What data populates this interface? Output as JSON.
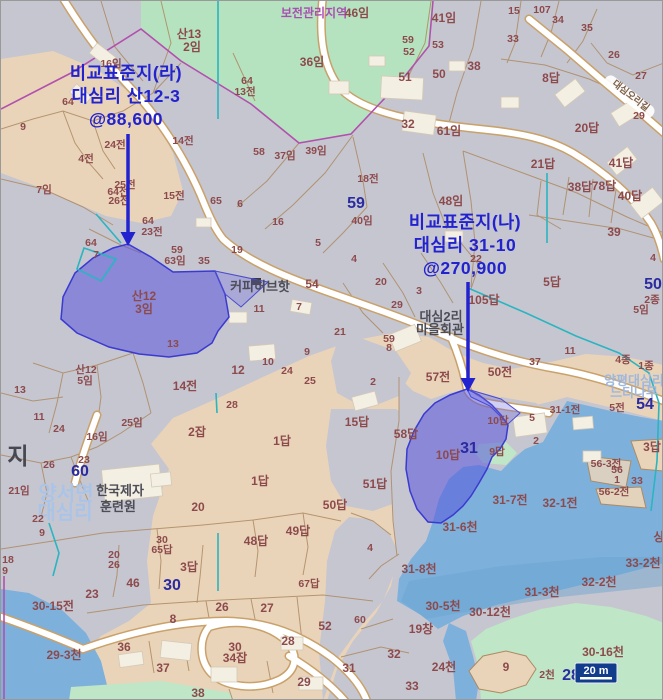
{
  "map": {
    "colors": {
      "base_gray": "#c6c6d0",
      "farmland_tan": "#e9d4ba",
      "forest_green": "#b5e3c0",
      "stream_blue": "#7db1dc",
      "highlight_parcel": "#5a55dc",
      "annotation_blue": "#2222cf",
      "lot_number_blue": "#2b2ba0",
      "parcel_text": "#8d4a4c",
      "zone_purple": "#a84fb0",
      "scalebar_navy": "#123c8c"
    },
    "annotations": [
      {
        "name": "비교표준지(라)",
        "lines": [
          "비교표준지(라)",
          "대심리 산12-3",
          "@88,600"
        ],
        "x": 125,
        "y": 78,
        "line_gap": 23,
        "arrow": {
          "x": 127,
          "y1": 133,
          "y2": 231
        }
      },
      {
        "name": "비교표준지(나)",
        "lines": [
          "비교표준지(나)",
          "대심리 31-10",
          "@270,900"
        ],
        "x": 464,
        "y": 227,
        "line_gap": 23,
        "arrow": {
          "x": 467,
          "y1": 281,
          "y2": 377
        }
      }
    ],
    "scale_bar": {
      "label": "20 m"
    },
    "labels": [
      [
        "산13",
        188,
        37,
        "p2"
      ],
      [
        "2임",
        191,
        50,
        "p2"
      ],
      [
        "보전관리지역",
        313,
        16,
        "pl"
      ],
      [
        "46임",
        356,
        16,
        "p2"
      ],
      [
        "36임",
        311,
        65,
        "p2"
      ],
      [
        "16임",
        110,
        66,
        "p"
      ],
      [
        "64",
        246,
        83,
        "p"
      ],
      [
        "13전",
        244,
        94,
        "p"
      ],
      [
        "41임",
        443,
        21,
        "p2"
      ],
      [
        "15",
        513,
        13,
        "p"
      ],
      [
        "107",
        541,
        12,
        "p"
      ],
      [
        "34",
        557,
        22,
        "p"
      ],
      [
        "35",
        586,
        30,
        "p"
      ],
      [
        "33",
        512,
        41,
        "p"
      ],
      [
        "26",
        613,
        57,
        "p"
      ],
      [
        "27",
        640,
        78,
        "p"
      ],
      [
        "29",
        638,
        118,
        "p"
      ],
      [
        "59",
        407,
        42,
        "p"
      ],
      [
        "52",
        408,
        54,
        "p"
      ],
      [
        "53",
        437,
        47,
        "p"
      ],
      [
        "50",
        438,
        77,
        "p2"
      ],
      [
        "51",
        404,
        80,
        "p2"
      ],
      [
        "38",
        473,
        69,
        "p2"
      ],
      [
        "8답",
        550,
        81,
        "p2"
      ],
      [
        "32",
        407,
        127,
        "p2"
      ],
      [
        "61임",
        448,
        134,
        "p2"
      ],
      [
        "20답",
        586,
        131,
        "p2"
      ],
      [
        "21답",
        542,
        167,
        "p2"
      ],
      [
        "41답",
        620,
        166,
        "p2"
      ],
      [
        "38답",
        579,
        190,
        "p2"
      ],
      [
        "78답",
        603,
        189,
        "p2"
      ],
      [
        "40답",
        629,
        199,
        "p2"
      ],
      [
        "39",
        613,
        235,
        "p2"
      ],
      [
        "4",
        652,
        260,
        "p"
      ],
      [
        "9",
        22,
        129,
        "p"
      ],
      [
        "24전",
        114,
        147,
        "p"
      ],
      [
        "4전",
        85,
        161,
        "p"
      ],
      [
        "14전",
        182,
        143,
        "p"
      ],
      [
        "58",
        258,
        154,
        "p"
      ],
      [
        "37임",
        284,
        158,
        "p"
      ],
      [
        "39임",
        315,
        153,
        "p"
      ],
      [
        "64",
        67,
        104,
        "p"
      ],
      [
        "7임",
        43,
        192,
        "p"
      ],
      [
        "25전",
        124,
        187,
        "p"
      ],
      [
        "64전",
        117,
        194,
        "p"
      ],
      [
        "26전",
        118,
        203,
        "p"
      ],
      [
        "15전",
        173,
        198,
        "p"
      ],
      [
        "64",
        147,
        223,
        "p"
      ],
      [
        "23전",
        151,
        234,
        "p"
      ],
      [
        "65",
        215,
        203,
        "p"
      ],
      [
        "6",
        239,
        206,
        "p"
      ],
      [
        "16",
        277,
        224,
        "p"
      ],
      [
        "5",
        317,
        245,
        "p"
      ],
      [
        "19",
        236,
        252,
        "p"
      ],
      [
        "59",
        176,
        252,
        "p"
      ],
      [
        "63임",
        174,
        263,
        "p"
      ],
      [
        "35",
        203,
        263,
        "p"
      ],
      [
        "64",
        90,
        245,
        "p"
      ],
      [
        "7",
        95,
        257,
        "p"
      ],
      [
        "산12",
        143,
        299,
        "p2"
      ],
      [
        "3임",
        143,
        312,
        "p2"
      ],
      [
        "커피허브핫",
        259,
        290,
        "place"
      ],
      [
        "54",
        311,
        287,
        "p2"
      ],
      [
        "11",
        258,
        311,
        "p"
      ],
      [
        "7",
        298,
        309,
        "p"
      ],
      [
        "21",
        339,
        334,
        "p"
      ],
      [
        "13",
        172,
        346,
        "p"
      ],
      [
        "18전",
        367,
        181,
        "p"
      ],
      [
        "59",
        355,
        207,
        "b"
      ],
      [
        "40임",
        361,
        223,
        "p"
      ],
      [
        "48임",
        450,
        204,
        "p2"
      ],
      [
        "22",
        475,
        261,
        "p"
      ],
      [
        "4",
        353,
        261,
        "p"
      ],
      [
        "20",
        380,
        284,
        "p"
      ],
      [
        "3",
        418,
        293,
        "p"
      ],
      [
        "29",
        396,
        307,
        "p"
      ],
      [
        "105답",
        483,
        303,
        "p2"
      ],
      [
        "5답",
        551,
        285,
        "p2"
      ],
      [
        "50",
        652,
        288,
        "b"
      ],
      [
        "2종",
        651,
        302,
        "p"
      ],
      [
        "5임",
        640,
        312,
        "p"
      ],
      [
        "대심2리",
        440,
        320,
        "place"
      ],
      [
        "마을회관",
        439,
        333,
        "place"
      ],
      [
        "59",
        388,
        341,
        "p"
      ],
      [
        "8",
        388,
        350,
        "p"
      ],
      [
        "산12",
        85,
        372,
        "p"
      ],
      [
        "5임",
        84,
        383,
        "p"
      ],
      [
        "13",
        19,
        392,
        "p"
      ],
      [
        "11",
        38,
        419,
        "p"
      ],
      [
        "24",
        58,
        431,
        "p"
      ],
      [
        "25임",
        131,
        425,
        "p"
      ],
      [
        "16임",
        96,
        439,
        "p"
      ],
      [
        "지",
        17,
        463,
        "bd"
      ],
      [
        "23",
        83,
        462,
        "p"
      ],
      [
        "26",
        48,
        467,
        "p"
      ],
      [
        "60",
        79,
        475,
        "b"
      ],
      [
        "21임",
        18,
        493,
        "p"
      ],
      [
        "양서면",
        65,
        499,
        "lb"
      ],
      [
        "대심리",
        64,
        518,
        "lb"
      ],
      [
        "22",
        37,
        521,
        "p"
      ],
      [
        "9",
        41,
        535,
        "p"
      ],
      [
        "한국제자",
        119,
        494,
        "place"
      ],
      [
        "훈련원",
        117,
        510,
        "place"
      ],
      [
        "14전",
        184,
        389,
        "p2"
      ],
      [
        "2잡",
        196,
        435,
        "p2"
      ],
      [
        "12",
        237,
        373,
        "p2"
      ],
      [
        "10",
        267,
        364,
        "p"
      ],
      [
        "9",
        306,
        354,
        "p"
      ],
      [
        "24",
        286,
        373,
        "p"
      ],
      [
        "25",
        309,
        383,
        "p"
      ],
      [
        "28",
        231,
        407,
        "p"
      ],
      [
        "1답",
        281,
        444,
        "p2"
      ],
      [
        "1답",
        259,
        484,
        "p2"
      ],
      [
        "20",
        197,
        510,
        "p2"
      ],
      [
        "50답",
        334,
        508,
        "p2"
      ],
      [
        "2",
        372,
        384,
        "p"
      ],
      [
        "57전",
        437,
        380,
        "p2"
      ],
      [
        "50전",
        499,
        375,
        "p2"
      ],
      [
        "37",
        534,
        364,
        "p"
      ],
      [
        "11",
        569,
        353,
        "p"
      ],
      [
        "4종",
        622,
        362,
        "p"
      ],
      [
        "1종",
        645,
        368,
        "p"
      ],
      [
        "양평대심리",
        633,
        384,
        "lb2"
      ],
      [
        "느티나무",
        633,
        396,
        "lb2"
      ],
      [
        "5전",
        616,
        410,
        "p"
      ],
      [
        "54",
        644,
        408,
        "b"
      ],
      [
        "31-1전",
        564,
        412,
        "p"
      ],
      [
        "5",
        531,
        420,
        "p"
      ],
      [
        "2",
        535,
        443,
        "p"
      ],
      [
        "10답",
        497,
        423,
        "p"
      ],
      [
        "15답",
        356,
        425,
        "p2"
      ],
      [
        "58답",
        405,
        437,
        "p2"
      ],
      [
        "10답",
        447,
        458,
        "p2"
      ],
      [
        "31",
        468,
        452,
        "b"
      ],
      [
        "9답",
        496,
        454,
        "p"
      ],
      [
        "3답",
        651,
        450,
        "p2"
      ],
      [
        "56-3전",
        605,
        466,
        "p"
      ],
      [
        "56",
        616,
        472,
        "p"
      ],
      [
        "1",
        616,
        482,
        "p"
      ],
      [
        "33",
        636,
        483,
        "p"
      ],
      [
        "31-7전",
        509,
        503,
        "p2"
      ],
      [
        "32-1전",
        559,
        506,
        "p2"
      ],
      [
        "56-2전",
        613,
        494,
        "p"
      ],
      [
        "51답",
        374,
        487,
        "p2"
      ],
      [
        "31-6천",
        459,
        530,
        "p2"
      ],
      [
        "4",
        369,
        550,
        "p"
      ],
      [
        "31-8천",
        418,
        572,
        "p2"
      ],
      [
        "33-2천",
        642,
        566,
        "p2"
      ],
      [
        "32-2천",
        598,
        585,
        "p2"
      ],
      [
        "31-3천",
        541,
        595,
        "p2"
      ],
      [
        "30-5천",
        442,
        609,
        "p2"
      ],
      [
        "30-12천",
        489,
        615,
        "p2"
      ],
      [
        "60",
        359,
        622,
        "p"
      ],
      [
        "19창",
        420,
        632,
        "p2"
      ],
      [
        "30-16천",
        602,
        655,
        "p2"
      ],
      [
        "32",
        393,
        657,
        "p2"
      ],
      [
        "31",
        348,
        671,
        "p2"
      ],
      [
        "24천",
        443,
        670,
        "p2"
      ],
      [
        "9",
        505,
        670,
        "p2"
      ],
      [
        "33",
        411,
        689,
        "p2"
      ],
      [
        "2천",
        546,
        677,
        "p"
      ],
      [
        "28",
        570,
        679,
        "b"
      ],
      [
        "상",
        658,
        540,
        "p2"
      ],
      [
        "18",
        7,
        562,
        "p"
      ],
      [
        "9",
        4,
        573,
        "p"
      ],
      [
        "30",
        161,
        542,
        "p"
      ],
      [
        "65답",
        161,
        552,
        "p"
      ],
      [
        "20",
        113,
        557,
        "p"
      ],
      [
        "26",
        113,
        567,
        "p"
      ],
      [
        "48답",
        255,
        544,
        "p2"
      ],
      [
        "49답",
        297,
        534,
        "p2"
      ],
      [
        "3답",
        188,
        570,
        "p2"
      ],
      [
        "46",
        132,
        586,
        "p2"
      ],
      [
        "30",
        171,
        589,
        "b"
      ],
      [
        "23",
        91,
        597,
        "p2"
      ],
      [
        "30-15전",
        52,
        609,
        "p2"
      ],
      [
        "67답",
        308,
        586,
        "p"
      ],
      [
        "26",
        221,
        610,
        "p2"
      ],
      [
        "27",
        266,
        611,
        "p2"
      ],
      [
        "8",
        172,
        622,
        "p2"
      ],
      [
        "52",
        324,
        629,
        "p2"
      ],
      [
        "28",
        287,
        644,
        "p2"
      ],
      [
        "36",
        123,
        650,
        "p2"
      ],
      [
        "30",
        234,
        650,
        "p2"
      ],
      [
        "34잡",
        234,
        661,
        "p2"
      ],
      [
        "29-3천",
        63,
        658,
        "p2"
      ],
      [
        "37",
        162,
        671,
        "p2"
      ],
      [
        "29",
        303,
        685,
        "p2"
      ],
      [
        "38",
        197,
        696,
        "p2"
      ],
      [
        "대심오리길",
        628,
        97,
        "road",
        38
      ]
    ]
  }
}
